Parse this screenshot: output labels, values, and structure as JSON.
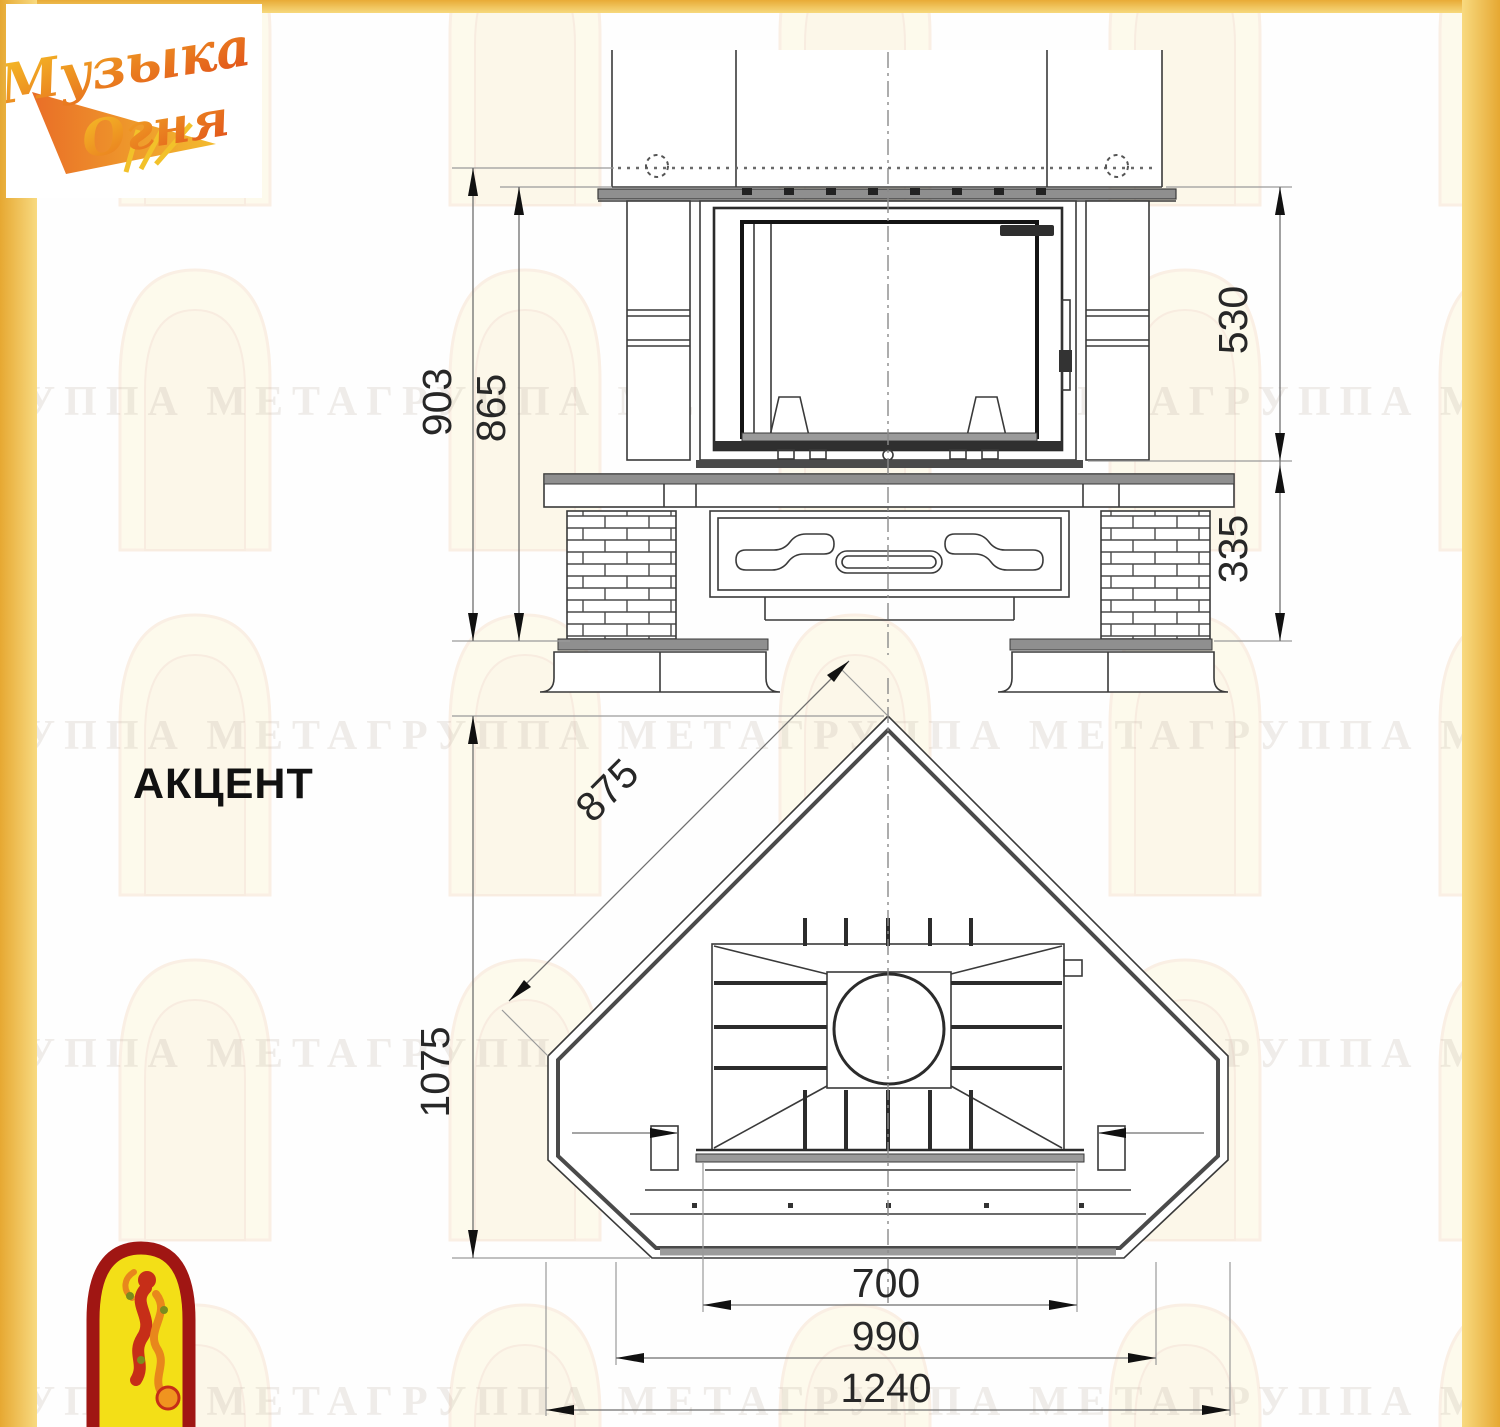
{
  "page": {
    "watermark_text": "ГРУППА МЕТАГРУППА МЕТАГРУППА МЕТАГРУППА МЕТАГРУППА МЕТА",
    "border_gold": "#edbb4a",
    "line_color": "#3a3a3a",
    "dimension_text_color": "#272727"
  },
  "logo": {
    "line1": "Музыка",
    "line2": "Огня",
    "color_start": "#f6c227",
    "color_end": "#e04a1a"
  },
  "model": {
    "title": "АКЦЕНТ"
  },
  "front_view": {
    "dimensions": {
      "overall_height": "903",
      "portal_height": "865",
      "firebox_height": "530",
      "base_height": "335"
    }
  },
  "plan_view": {
    "dimensions": {
      "side_width": "875",
      "depth": "1075",
      "opening_width": "700",
      "mid_width": "990",
      "overall_width": "1240"
    }
  }
}
